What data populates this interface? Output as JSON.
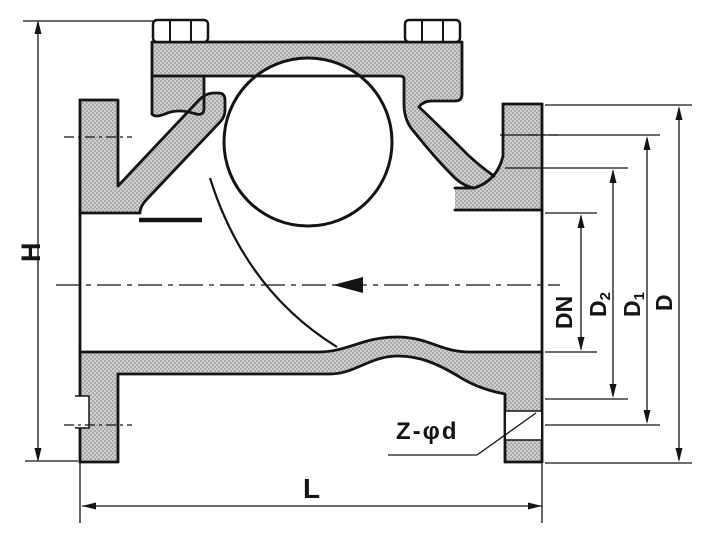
{
  "drawing": {
    "kind": "flanged-check-valve-sectional-drawing",
    "colors": {
      "line": "#141414",
      "section_fill": "#c9c9c9",
      "section_dot": "#a9a9a9",
      "background": "#ffffff"
    },
    "labels": {
      "height": "H",
      "length": "L",
      "nominal_bore": "DN",
      "raised_face_base": "D",
      "raised_face_sub": "2",
      "bolt_circle_base": "D",
      "bolt_circle_sub": "1",
      "flange_od": "D",
      "bolt_holes": "Z-φd"
    }
  }
}
